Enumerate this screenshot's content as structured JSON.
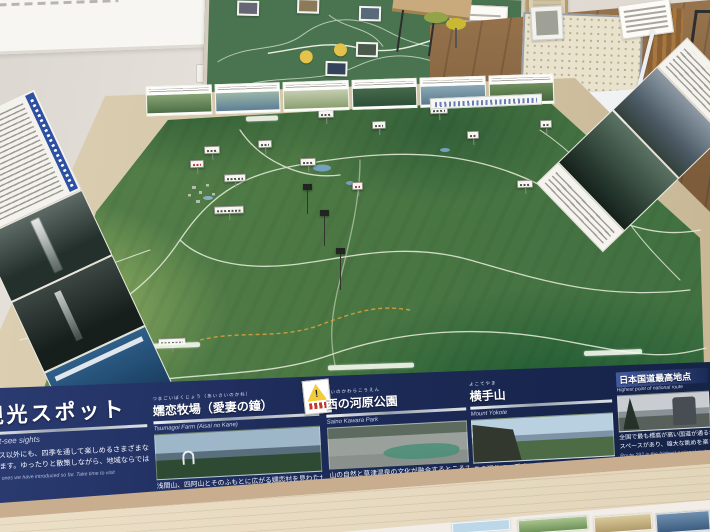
{
  "colors": {
    "panel_navy": "#1d2b59",
    "table_frame": "#d8cbae",
    "terrain_green": "#4e7a40",
    "accent_silver": "#c9d0d8",
    "warning_yellow": "#f3cb3a"
  },
  "panels": {
    "intro": {
      "title_jp": "観光スポット",
      "title_en": "Must-see sights",
      "body_jp": [
        "コース以外にも、四季を通して楽しめるさまざまな",
        "あります。ゆったりと散策しながら、地域ならでは"
      ],
      "body_en": [
        "on the ones we have introduced so far. Take time to visit",
        "here."
      ]
    },
    "spots": [
      {
        "title_jp": "嬬恋牧場（愛妻の鐘）",
        "ruby": "つまごいぼくじょう（あいさいのかね）",
        "title_en": "Tsumagoi Farm (Aisai no Kane)",
        "body_jp": [
          "浅間山、四阿山とそのふもとに広がる嬬恋村を見わたせます。愛妻家の方",
          "は「愛妻の鐘」を鳴らしてみてください。"
        ],
        "body_en": [
          "Look over the village of Tsumagoi spreading across the feet of Mount Asama and Mount Azumaya."
        ],
        "warning_mark": "!"
      },
      {
        "title_jp": "西の河原公園",
        "ruby": "さいのかわらこうえん",
        "title_en": "Saino Kawara Park",
        "body_jp": [
          "山の自然と草津温泉の文化が融合するところです。レンゲツツジに囲まれた",
          "道や、大きな露天風呂、足湯などが整備されています。"
        ],
        "body_en": [
          "Enjoy the park's beautiful azalea-lined",
          "passages and heavenly outdoor public baths and foot bath."
        ]
      },
      {
        "title_jp": "横手山",
        "ruby": "よこてやま",
        "title_en": "Mount Yokote",
        "body_jp": [
          "この辺りで一番高い標高2,307mの山頂には、展望台やヒュッテが有り、",
          "歩道やリフトで登ることができます。富士山や北アルプスも望めます。"
        ],
        "body_en": [
          "Mount Yokote is the tallest mountain in this area. At the top of the mountain, which stands at 2,307",
          "meters high, is an observation deck and lodging."
        ]
      },
      {
        "title_jp": "日本国道最高地点",
        "title_en": "Highest point of national route",
        "body_jp": [
          "全国で最も標高が高い国道が通る地点。記念碑の",
          "スペースがあり、雄大な眺めを楽しめます。"
        ],
        "body_en": [
          "Route 292 is the highest national route in Japan."
        ]
      }
    ]
  },
  "map": {
    "flags": [
      {
        "x": 204,
        "y": 146,
        "w": 16
      },
      {
        "x": 190,
        "y": 160,
        "w": 14,
        "red": 1
      },
      {
        "x": 224,
        "y": 174,
        "w": 22
      },
      {
        "x": 214,
        "y": 206,
        "w": 30
      },
      {
        "x": 300,
        "y": 158,
        "w": 16
      },
      {
        "x": 318,
        "y": 110,
        "w": 16
      },
      {
        "x": 372,
        "y": 121,
        "w": 14
      },
      {
        "x": 430,
        "y": 106,
        "w": 18
      },
      {
        "x": 585,
        "y": 146,
        "w": 14
      },
      {
        "x": 517,
        "y": 180,
        "w": 16
      },
      {
        "x": 106,
        "y": 322,
        "w": 22
      },
      {
        "x": 158,
        "y": 338,
        "w": 28
      },
      {
        "x": 94,
        "y": 250,
        "w": 18
      },
      {
        "x": 258,
        "y": 140,
        "w": 14
      },
      {
        "x": 467,
        "y": 131,
        "w": 12
      },
      {
        "x": 540,
        "y": 120,
        "w": 12
      },
      {
        "x": 352,
        "y": 182,
        "w": 11,
        "red": 1
      }
    ],
    "tall_pins": [
      {
        "x": 303,
        "y": 184,
        "h": 24
      },
      {
        "x": 320,
        "y": 210,
        "h": 30
      },
      {
        "x": 336,
        "y": 248,
        "h": 36
      }
    ],
    "surface_labels": [
      {
        "x": 92,
        "y": 328,
        "w": 40
      },
      {
        "x": 146,
        "y": 343,
        "w": 54
      },
      {
        "x": 328,
        "y": 364,
        "w": 86
      },
      {
        "x": 584,
        "y": 350,
        "w": 58
      },
      {
        "x": 246,
        "y": 116,
        "w": 32
      },
      {
        "x": 118,
        "y": 357,
        "w": 30
      }
    ]
  }
}
